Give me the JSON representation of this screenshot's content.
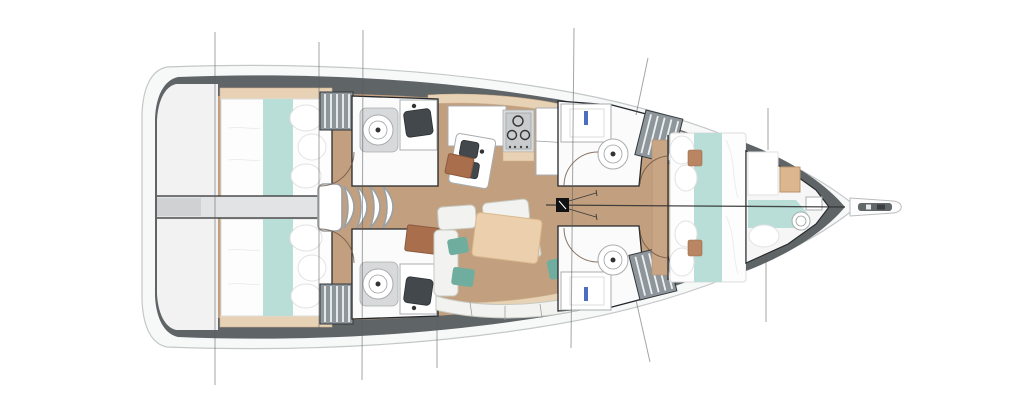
{
  "palette": {
    "hull_white": "#f7f8f8",
    "hull_stroke": "#c4c7c9",
    "gunwale": "#5f6467",
    "transom": "#f2f2f3",
    "floor": "#c2a07f",
    "trim": "#e7d2b5",
    "bed_white": "#fdfdfd",
    "teal": "#b9ded8",
    "teal_dark": "#6fae9f",
    "locker": "#8e969b",
    "fixture": "#fbfbfb",
    "fixture_stroke": "#a9adb0",
    "wood_desk": "#a96f4d",
    "table": "#eccfad",
    "sofa": "#f2f3f0",
    "sofa_stroke": "#c6c9c1",
    "dark_line": "#2e2e2e",
    "station": "#5b5b5b",
    "sink_dark": "#43484c",
    "blue_faucet": "#4a6fc0"
  },
  "diagram": {
    "type": "yacht-interior-floor-plan",
    "view": "top-down",
    "orientation": "bow-right-stern-left",
    "regions": [
      {
        "id": "swim-platform-transom"
      },
      {
        "id": "aft-cabin-port",
        "features": [
          "double-berth",
          "teal-runner",
          "pillows"
        ]
      },
      {
        "id": "aft-cabin-starboard",
        "features": [
          "double-berth",
          "teal-runner",
          "pillows"
        ]
      },
      {
        "id": "engine-hatch-corridor"
      },
      {
        "id": "companionway-steps",
        "step_count": 4
      },
      {
        "id": "aft-head-port",
        "fixtures": [
          "toilet",
          "sink"
        ]
      },
      {
        "id": "aft-head-starboard",
        "fixtures": [
          "toilet",
          "sink"
        ]
      },
      {
        "id": "galley",
        "fixtures": [
          "double-sink",
          "three-burner-stove",
          "fridge"
        ]
      },
      {
        "id": "nav-desk"
      },
      {
        "id": "salon",
        "features": [
          "sofa",
          "dining-table",
          "cushions"
        ]
      },
      {
        "id": "fwd-head-port",
        "fixtures": [
          "sink",
          "toilet"
        ]
      },
      {
        "id": "fwd-head-starboard",
        "fixtures": [
          "sink",
          "toilet"
        ]
      },
      {
        "id": "hanging-lockers",
        "count": 4
      },
      {
        "id": "owner-cabin",
        "features": [
          "v-berth",
          "teal-runner",
          "pillows"
        ]
      },
      {
        "id": "forepeak-cabin",
        "features": [
          "berth",
          "wardrobe",
          "toilet",
          "sink"
        ]
      },
      {
        "id": "mast-post"
      },
      {
        "id": "bowsprit-anchor-roller"
      }
    ],
    "station_lines_x": [
      215,
      319,
      363,
      437,
      573,
      642,
      768
    ]
  }
}
